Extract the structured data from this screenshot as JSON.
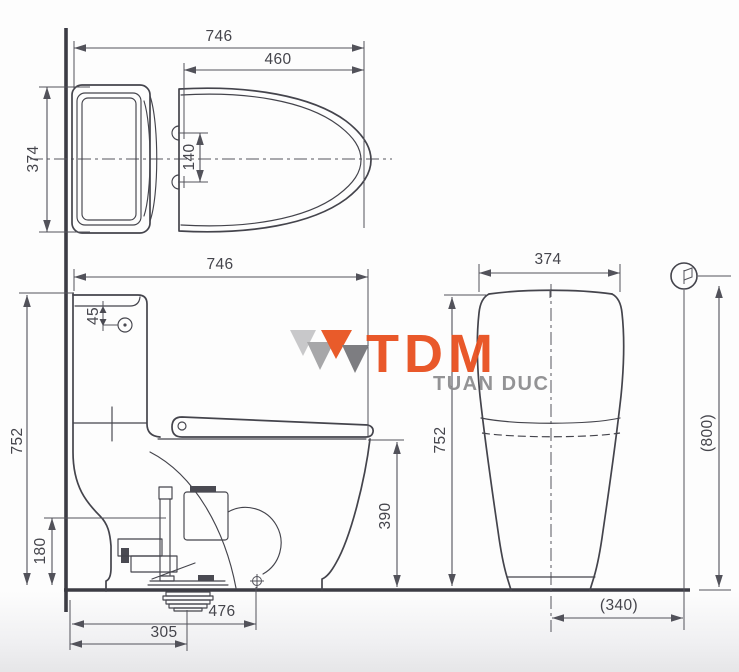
{
  "colors": {
    "line": "#44444c",
    "dimension_text": "#45454c",
    "accent_orange": "#e8501f",
    "logo_gray": "#8e8e90",
    "background": "#fdfdfd"
  },
  "watermark": {
    "brand": "TDM",
    "company": "TUAN DUC"
  },
  "views": {
    "top": {
      "total_length": "746",
      "lid_length": "460",
      "width": "374",
      "hinge_spacing": "140"
    },
    "front": {
      "total_length": "746",
      "button_offset": "45",
      "height": "752",
      "inlet_height": "180",
      "rim_height": "390",
      "bolt_distance": "476",
      "trap_distance": "305"
    },
    "side": {
      "width": "374",
      "height": "752",
      "supply_height": "(800)",
      "supply_offset": "(340)"
    }
  },
  "icons": {
    "supply_valve": "water-supply-icon",
    "floor_bolt": "floor-bolt-icon",
    "logo_mark": "tdm-logo-mark-icon"
  }
}
